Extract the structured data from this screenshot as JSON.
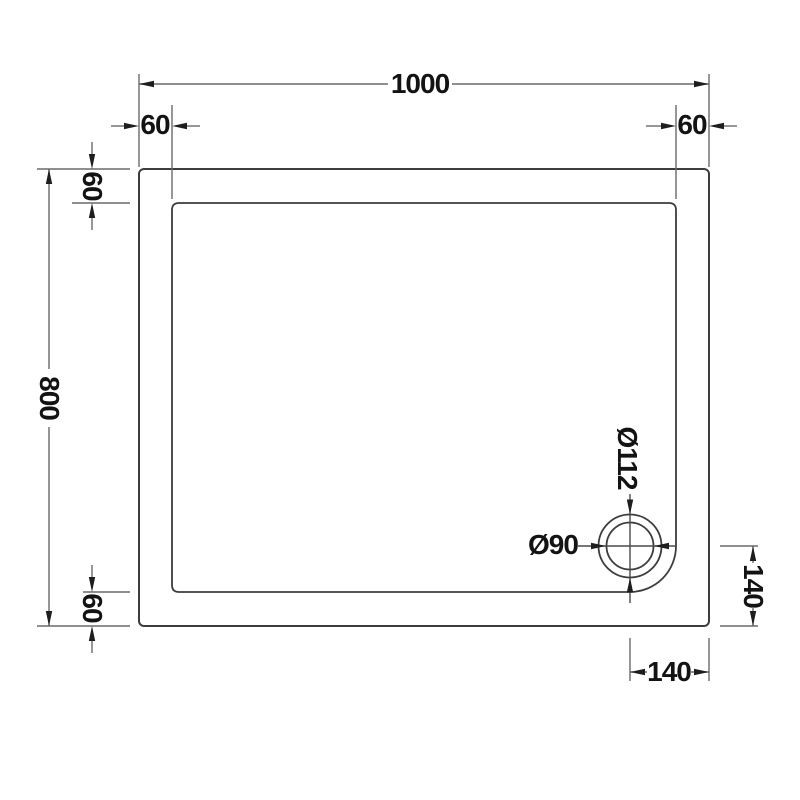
{
  "drawing": {
    "type": "shower-tray-plan-technical-drawing",
    "labels": {
      "overall_width": "1000",
      "edge_top_left": "60",
      "edge_top_right": "60",
      "overall_depth": "800",
      "edge_left_top": "60",
      "edge_left_bottom": "60",
      "drain_flange_diameter": "Ø112",
      "drain_waste_diameter": "Ø90",
      "drain_offset_right": "140",
      "drain_offset_bottom": "140"
    },
    "colors": {
      "background": "#ffffff",
      "drawing_edge": "#3d3d3d",
      "dimension_line": "#6a6a6a",
      "text": "#131313",
      "arrowhead": "#1e1e1e"
    }
  }
}
